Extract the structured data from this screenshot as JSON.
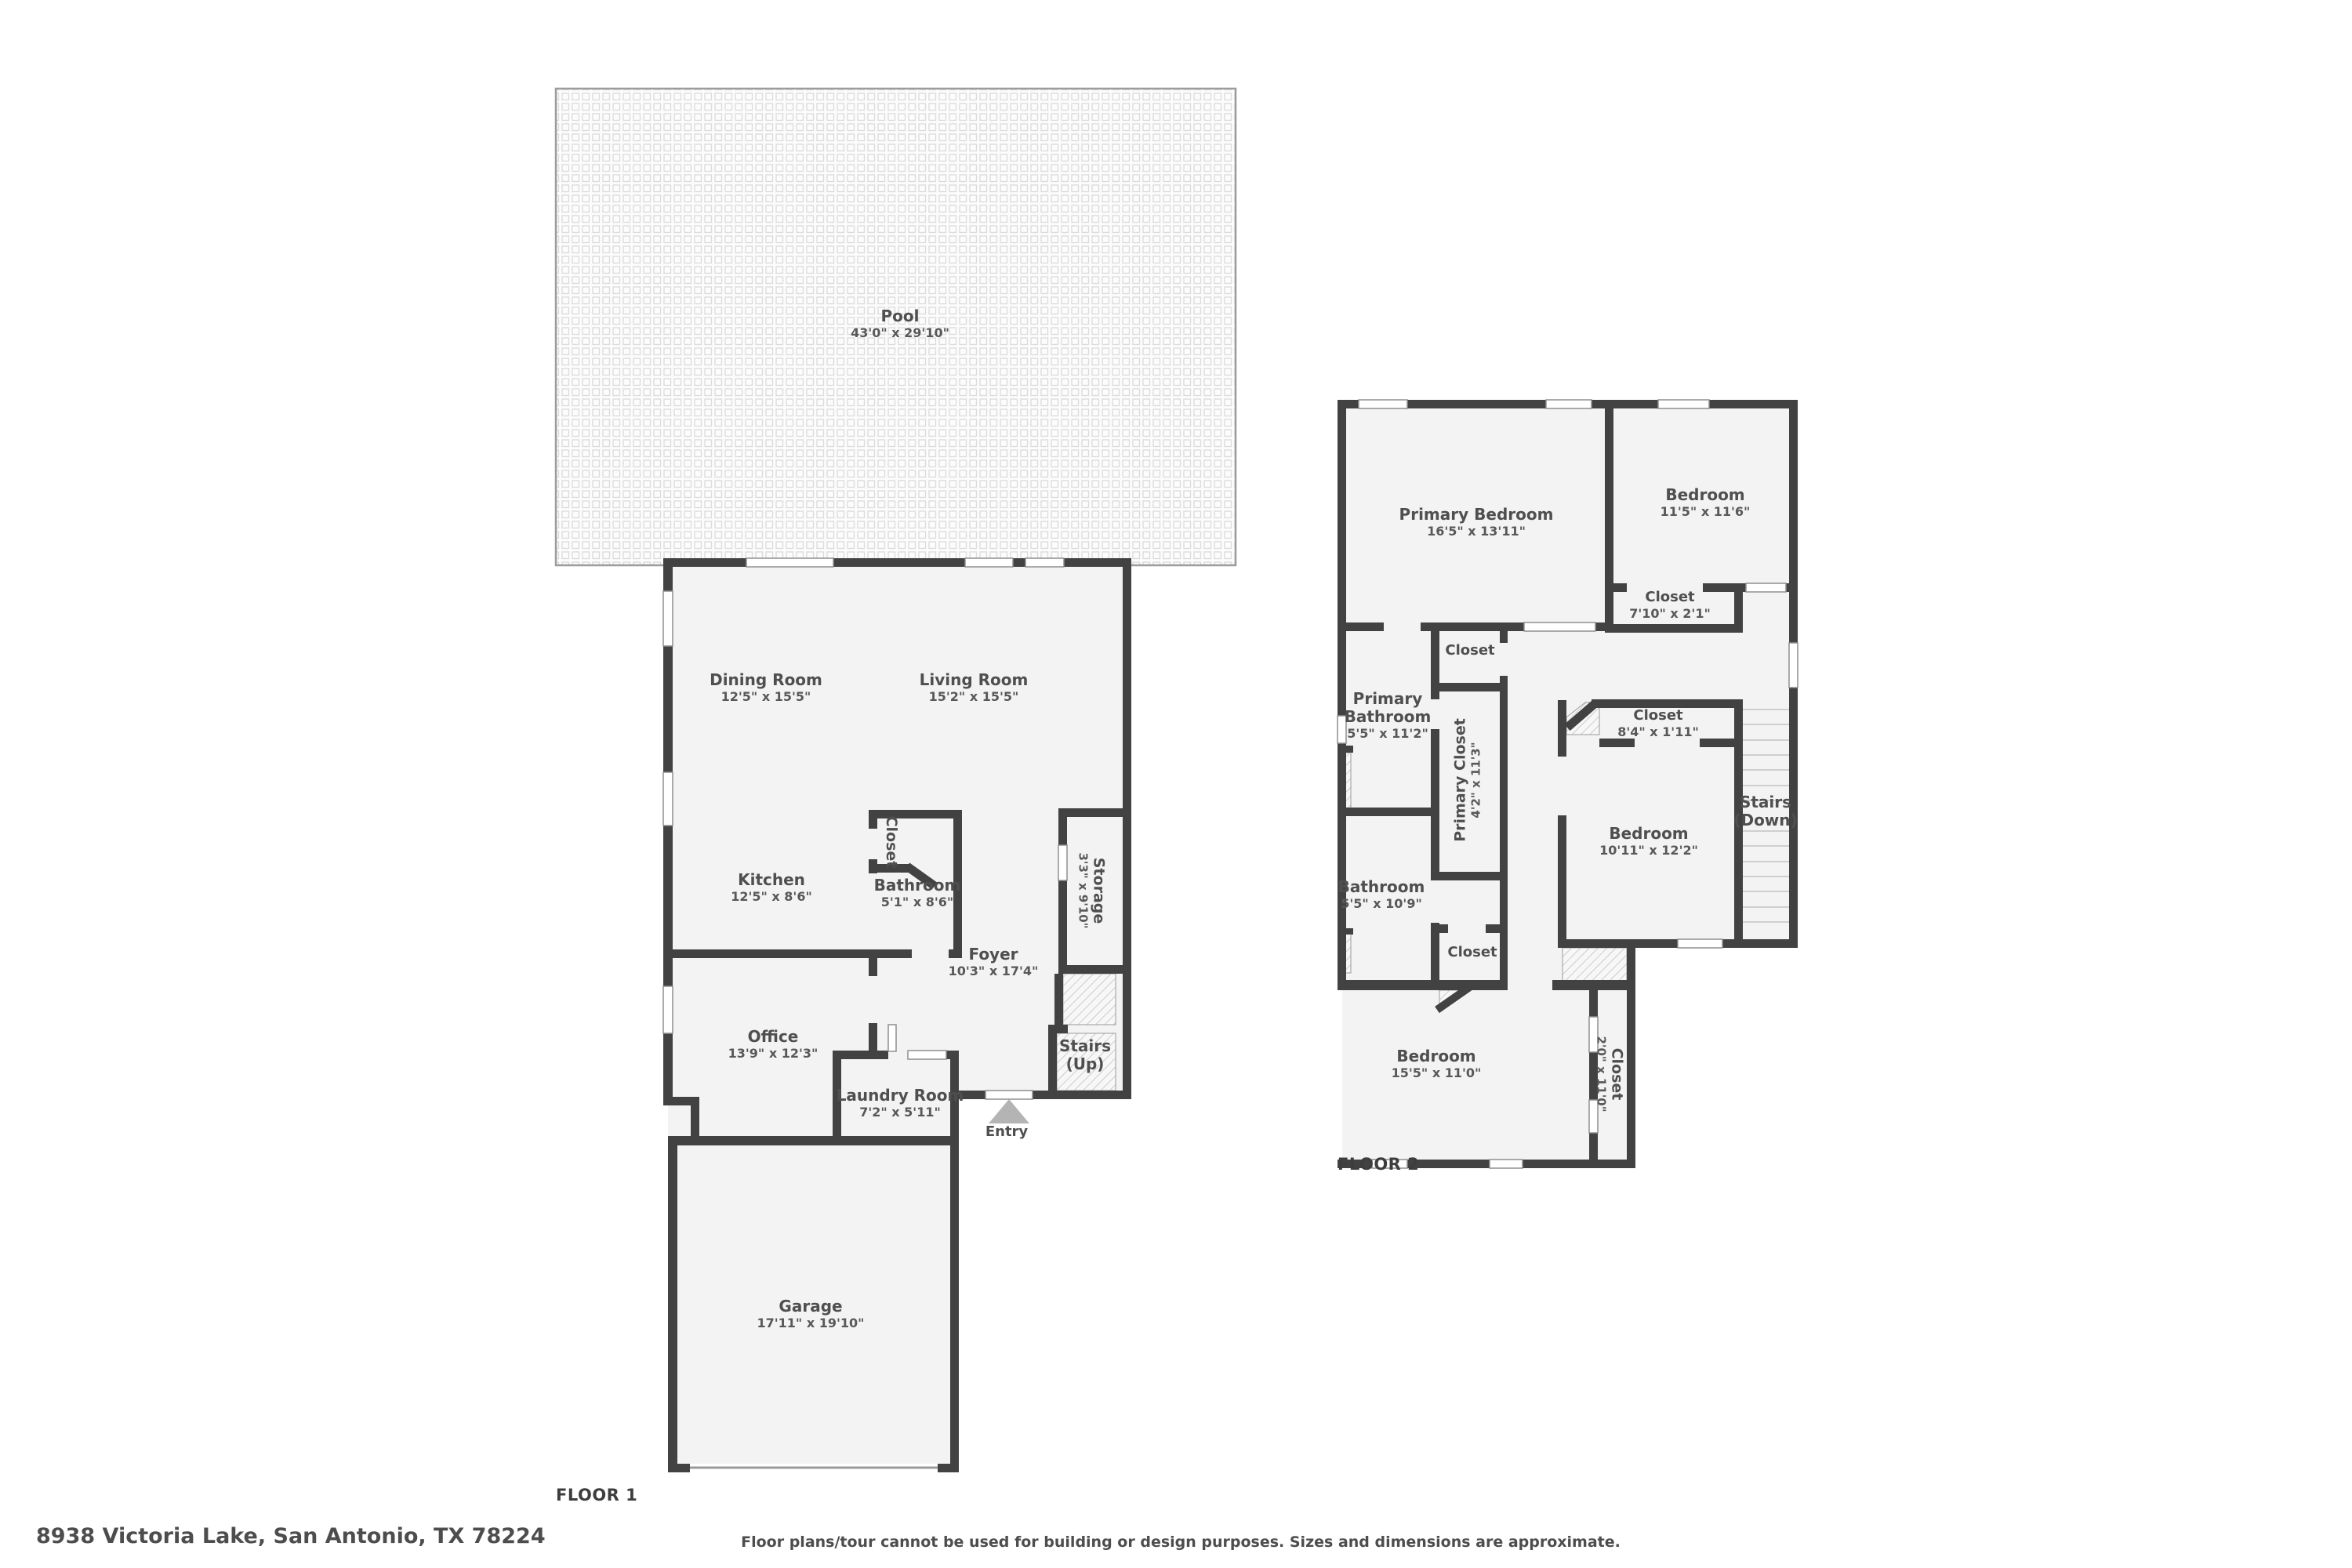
{
  "meta": {
    "address": "8938 Victoria Lake, San Antonio, TX 78224",
    "disclaimer": "Floor plans/tour cannot be used for building or design purposes. Sizes and dimensions are approximate.",
    "floor1_label": "FLOOR 1",
    "floor2_label": "FLOOR 2"
  },
  "colors": {
    "wall": "#424242",
    "room_fill": "#f3f3f3",
    "outside": "#ffffff",
    "hatch_line": "#b5b5b5",
    "pool_tile_line": "#dcdcdc",
    "stair_tread": "#cfcfcf",
    "entry_arrow": "#b4b4b4",
    "text": "#4f4f4f"
  },
  "floor1": {
    "label": "FLOOR 1",
    "rooms": [
      {
        "name": "Pool",
        "dims": "43'0\" x 29'10\""
      },
      {
        "name": "Dining Room",
        "dims": "12'5\" x 15'5\""
      },
      {
        "name": "Living Room",
        "dims": "15'2\" x 15'5\""
      },
      {
        "name": "Kitchen",
        "dims": "12'5\" x 8'6\""
      },
      {
        "name": "Closet"
      },
      {
        "name": "Bathroom",
        "dims": "5'1\" x 8'6\""
      },
      {
        "name": "Storage",
        "dims": "3'3\" x 9'10\""
      },
      {
        "name": "Foyer",
        "dims": "10'3\" x 17'4\""
      },
      {
        "name": "Office",
        "dims": "13'9\" x 12'3\""
      },
      {
        "name": "Laundry Room",
        "dims": "7'2\" x 5'11\""
      },
      {
        "name": "Stairs",
        "dims": "(Up)"
      },
      {
        "name": "Entry"
      },
      {
        "name": "Garage",
        "dims": "17'11\" x 19'10\""
      }
    ]
  },
  "floor2": {
    "label": "FLOOR 2",
    "rooms": [
      {
        "name": "Primary Bedroom",
        "dims": "16'5\" x 13'11\""
      },
      {
        "name": "Bedroom",
        "dims": "11'5\" x 11'6\""
      },
      {
        "name": "Closet",
        "dims": "7'10\" x 2'1\""
      },
      {
        "name": "Closet"
      },
      {
        "name": "Primary\nBathroom",
        "dims": "5'5\" x 11'2\""
      },
      {
        "name": "Primary Closet",
        "dims": "4'2\" x 11'3\""
      },
      {
        "name": "Closet",
        "dims": "8'4\" x 1'11\""
      },
      {
        "name": "Bedroom",
        "dims": "10'11\" x 12'2\""
      },
      {
        "name": "Stairs",
        "dims": "(Down)"
      },
      {
        "name": "Bathroom",
        "dims": "5'5\" x 10'9\""
      },
      {
        "name": "Closet"
      },
      {
        "name": "Bedroom",
        "dims": "15'5\" x 11'0\""
      },
      {
        "name": "Closet",
        "dims": "2'0\" x 11'0\""
      }
    ]
  }
}
